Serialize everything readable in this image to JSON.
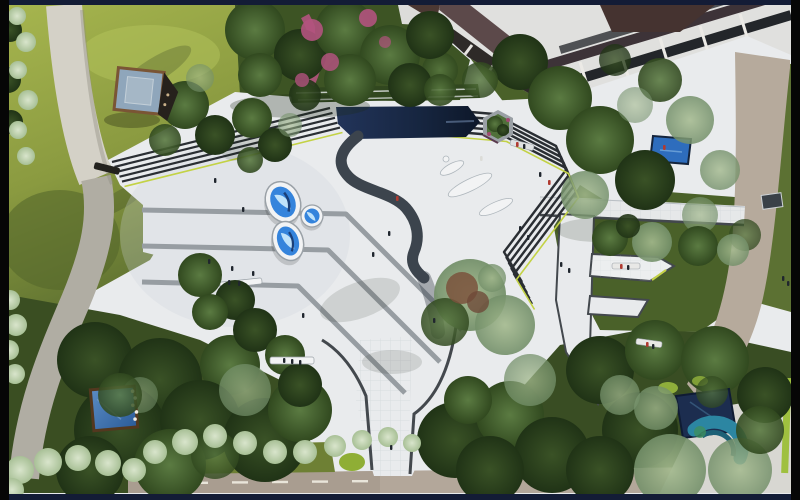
{
  "meta": {
    "description": "Aerial top-down architectural rendering of a landscaped courtyard plaza with a dark reflecting pool, striped terrace steps, three oval mirror pools, tree groves, lawns, curving paths, perimeter roads and small ponds beside a building",
    "view": "bird's-eye plan view",
    "style": "photorealistic landscape-architecture visualization",
    "visible_text": "none"
  },
  "palette": {
    "frame_navy": "#131c36",
    "frame_black": "#060606",
    "plaza": "#e9ebed",
    "plaza_shadow": "#cfd6db",
    "tile_line": "#c6ccd1",
    "pool_navy": "#1b2b47",
    "pool_deep": "#0d1729",
    "ribbon": "#3c444d",
    "band_gray": "#979da2",
    "stripe_dark": "#2a2e33",
    "chartreuse": "#c3d245",
    "lawn_light": "#a6b54e",
    "lawn_mid": "#7d8d3a",
    "lawn_dark": "#4a6129",
    "ground_dark": "#3a4e22",
    "tree_mid": "#4f6e3a",
    "tree_dark": "#2c4220",
    "tree_sage": "#93ab7f",
    "hedge_light": "#c2d4b0",
    "autumn_red": "#7a523c",
    "flower_pink": "#b2537e",
    "path_white": "#d4d1c7",
    "path_gray": "#b0ada3",
    "road_beige": "#b3a79a",
    "road_line": "#e9e5da",
    "mirror_blue": "#3584dc",
    "mirror_light": "#bfe2fa",
    "mirror_deep": "#1a3f78",
    "pond_blue": "#4478b6",
    "pond_navy": "#1c2d4f",
    "pond_teal": "#2c86a2",
    "pond_green": "#3f8f5f",
    "building_white": "#e0e0de",
    "glass_dark": "#23262a",
    "wood_brown": "#4a3632",
    "glass_blue": "#8fa6bb",
    "bench_white": "#f2f3f4",
    "curb": "#43484d",
    "figure_dark": "#20262e",
    "figure_red": "#b03a30",
    "figure_white": "#dcdcd8"
  },
  "scene": {
    "setting": "courtyard plaza between a building (top right) and park lawns, framed by dark letterbox bars",
    "features": [
      {
        "name": "reflecting-pool",
        "description": "long dark navy pool at top center with black-and-white striped terrace steps on both sides and a clipped hedge band along its top edge"
      },
      {
        "name": "water-ribbon",
        "description": "dark gray ribbon curving out of the pool onto the white plaza"
      },
      {
        "name": "mirror-pools",
        "description": "three oval sky-blue mirror pools with white rims on the west plaza",
        "count": 3
      },
      {
        "name": "paving-bands",
        "description": "three thin gray paving bands running east then bending 45 degrees to the southeast",
        "count": 3
      },
      {
        "name": "hexagon-planter",
        "description": "gray hexagonal tree planter at the east end of the pool steps"
      },
      {
        "name": "glass-pavilion",
        "description": "small square glass-roof pavilion with corten frame on the northwest lawn"
      },
      {
        "name": "curved-path",
        "description": "white path curving from the top edge into the plaza, continuing as a gray path to the bottom left"
      },
      {
        "name": "building",
        "description": "concrete building corner at top right with white beams, dark glazing and brown panels"
      },
      {
        "name": "e-shaped-terrace",
        "description": "white E-shaped paved terrace with dark curbs and benches on the east side"
      },
      {
        "name": "central-walkway",
        "description": "tiled walkway leading south from the plaza to the bottom road"
      },
      {
        "name": "bottom-road",
        "description": "beige road along the bottom edge with dashed white centerline"
      },
      {
        "name": "right-road",
        "description": "beige road running down the right edge beside a lawn strip and small signboard"
      },
      {
        "name": "square-pond-west",
        "description": "blue square pond with timber edge and white blossoms in the southwest grove"
      },
      {
        "name": "corner-ponds-southeast",
        "description": "navy square pond and teal crescent pond among trees in the southeast corner"
      },
      {
        "name": "small-pond-northeast",
        "description": "small blue pond below the building"
      },
      {
        "name": "flowering-trees",
        "description": "magenta flowering patches and pink path in the north tree grove"
      },
      {
        "name": "hedges",
        "description": "fluffy pale sage hedge bands along the left edge and bottom"
      },
      {
        "name": "benches",
        "description": "white sculptural benches mid-plaza and straight benches with seated figures",
        "count": 6
      },
      {
        "name": "pedestrians",
        "description": "small figures walking and sitting across the plaza and steps",
        "approx_count": 28
      }
    ]
  }
}
